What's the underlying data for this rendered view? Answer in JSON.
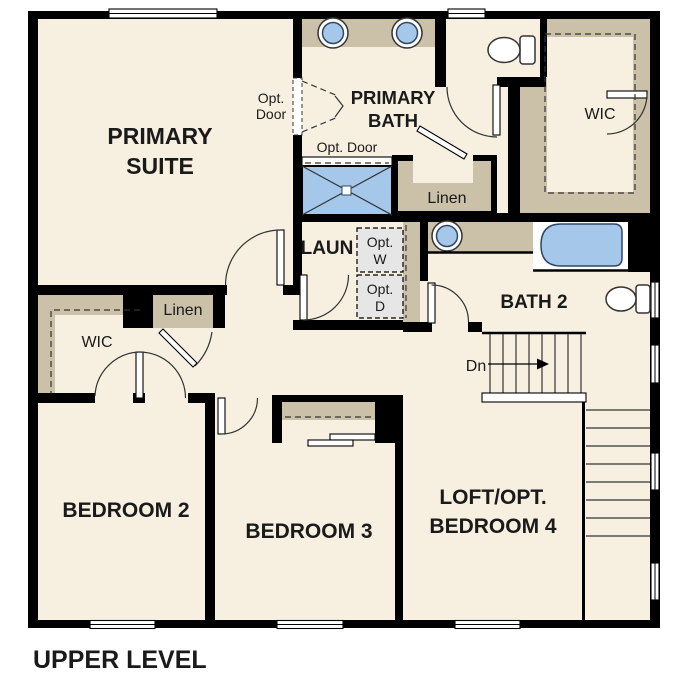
{
  "title": "UPPER LEVEL",
  "colors": {
    "floor": "#f7f0e1",
    "cabinet": "#cbc0a8",
    "wall": "#000000",
    "fixture_blue": "#a5c8ea",
    "fixture_stroke": "#2f4763",
    "appliance_gray": "#e6e6e6"
  },
  "rooms": {
    "primary_suite": {
      "line1": "PRIMARY",
      "line2": "SUITE"
    },
    "primary_bath": {
      "line1": "PRIMARY",
      "line2": "BATH"
    },
    "wic_primary": {
      "label": "WIC"
    },
    "linen_bath": {
      "label": "Linen"
    },
    "laundry": {
      "label": "LAUN"
    },
    "bath_2": {
      "label": "BATH 2"
    },
    "wic_hall": {
      "label": "WIC"
    },
    "linen_hall": {
      "label": "Linen"
    },
    "bedroom_2": {
      "label": "BEDROOM 2"
    },
    "bedroom_3": {
      "label": "BEDROOM 3"
    },
    "loft": {
      "line1": "LOFT/OPT.",
      "line2": "BEDROOM 4"
    }
  },
  "annotations": {
    "opt_door_suite": {
      "line1": "Opt.",
      "line2": "Door"
    },
    "opt_door_shower": {
      "label": "Opt. Door"
    },
    "opt_washer": {
      "line1": "Opt.",
      "line2": "W"
    },
    "opt_dryer": {
      "line1": "Opt.",
      "line2": "D"
    },
    "stairs_down": {
      "label": "Dn"
    }
  }
}
